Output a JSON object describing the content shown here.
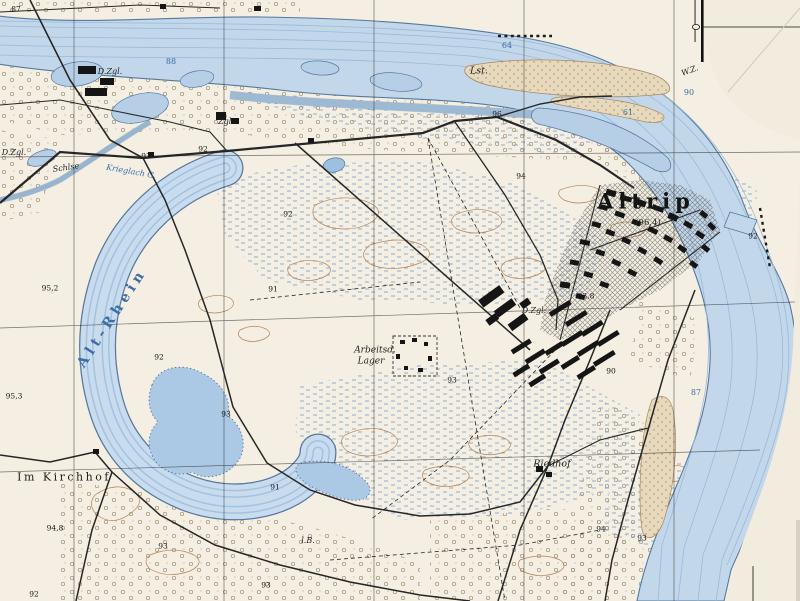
{
  "map": {
    "colors": {
      "paper": "#f4efe2",
      "margin_paper": "#f1ecdd",
      "water_fill": "#c3d7ea",
      "water_flowline": "#99b9d8",
      "water_edge": "#54799f",
      "water_label": "#3c6ea6",
      "contour_brown": "#b5835a",
      "scrub": "#8d7d62",
      "road_black": "#262626"
    },
    "labels": [
      {
        "t": "Altrip",
        "cls": "town",
        "x": 646,
        "y": 201
      },
      {
        "t": "(96,4)",
        "cls": "elev",
        "x": 648,
        "y": 223
      },
      {
        "t": "Alt-Rhein",
        "cls": "river",
        "x": 112,
        "y": 318,
        "rot": -57
      },
      {
        "t": "Arbeitsd.",
        "cls": "ital",
        "x": 375,
        "y": 351
      },
      {
        "t": "Lager",
        "cls": "ital",
        "x": 371,
        "y": 362
      },
      {
        "t": "Im Kirchhof",
        "cls": "place",
        "x": 64,
        "y": 477
      },
      {
        "t": "Riedhof",
        "cls": "ital2",
        "x": 552,
        "y": 464
      },
      {
        "t": "Schlse",
        "cls": "small",
        "x": 66,
        "y": 168,
        "rot": -8
      },
      {
        "t": "Krieglach G.",
        "cls": "watersm",
        "x": 131,
        "y": 172,
        "rot": 10
      },
      {
        "t": "D.Zgl.",
        "cls": "small",
        "x": 110,
        "y": 72
      },
      {
        "t": "Zgl.",
        "cls": "small",
        "x": 226,
        "y": 122
      },
      {
        "t": "D.Zgl.",
        "cls": "small",
        "x": 534,
        "y": 311
      },
      {
        "t": "D.Zgl.",
        "cls": "small",
        "x": 14,
        "y": 153
      },
      {
        "t": "Lst.",
        "cls": "ital2",
        "x": 479,
        "y": 71
      },
      {
        "t": "W.Z.",
        "cls": "small",
        "x": 690,
        "y": 71,
        "rot": -20
      },
      {
        "t": "l.B.",
        "cls": "small",
        "x": 308,
        "y": 541
      },
      {
        "t": "64",
        "cls": "wnum",
        "x": 507,
        "y": 46
      },
      {
        "t": "88",
        "cls": "wnum",
        "x": 171,
        "y": 62
      },
      {
        "t": "61",
        "cls": "wnum",
        "x": 628,
        "y": 113
      },
      {
        "t": "90",
        "cls": "wnum",
        "x": 689,
        "y": 93
      },
      {
        "t": "87",
        "cls": "wnum",
        "x": 696,
        "y": 393
      },
      {
        "t": "87",
        "cls": "hnum",
        "x": 16,
        "y": 9
      },
      {
        "t": "93",
        "cls": "hnum",
        "x": 146,
        "y": 156
      },
      {
        "t": "92",
        "cls": "hnum",
        "x": 203,
        "y": 149
      },
      {
        "t": "96",
        "cls": "hnum",
        "x": 497,
        "y": 114
      },
      {
        "t": "94",
        "cls": "hnum",
        "x": 521,
        "y": 176
      },
      {
        "t": "92",
        "cls": "hnum",
        "x": 288,
        "y": 214
      },
      {
        "t": "91",
        "cls": "hnum",
        "x": 273,
        "y": 289
      },
      {
        "t": "92",
        "cls": "hnum",
        "x": 159,
        "y": 357
      },
      {
        "t": "95,2",
        "cls": "hnum",
        "x": 50,
        "y": 288
      },
      {
        "t": "95,3",
        "cls": "hnum",
        "x": 14,
        "y": 396
      },
      {
        "t": "93",
        "cls": "hnum",
        "x": 226,
        "y": 414
      },
      {
        "t": "93,8",
        "cls": "hnum",
        "x": 586,
        "y": 296
      },
      {
        "t": "90",
        "cls": "hnum",
        "x": 611,
        "y": 371
      },
      {
        "t": "92",
        "cls": "hnum",
        "x": 753,
        "y": 236
      },
      {
        "t": "93",
        "cls": "hnum",
        "x": 452,
        "y": 380
      },
      {
        "t": "91",
        "cls": "hnum",
        "x": 275,
        "y": 487
      },
      {
        "t": "94,8",
        "cls": "hnum",
        "x": 55,
        "y": 528
      },
      {
        "t": "93",
        "cls": "hnum",
        "x": 163,
        "y": 546
      },
      {
        "t": "92",
        "cls": "hnum",
        "x": 34,
        "y": 594
      },
      {
        "t": "93",
        "cls": "hnum",
        "x": 266,
        "y": 585
      },
      {
        "t": "94",
        "cls": "hnum",
        "x": 601,
        "y": 529
      },
      {
        "t": "93",
        "cls": "hnum",
        "x": 642,
        "y": 538
      }
    ]
  }
}
